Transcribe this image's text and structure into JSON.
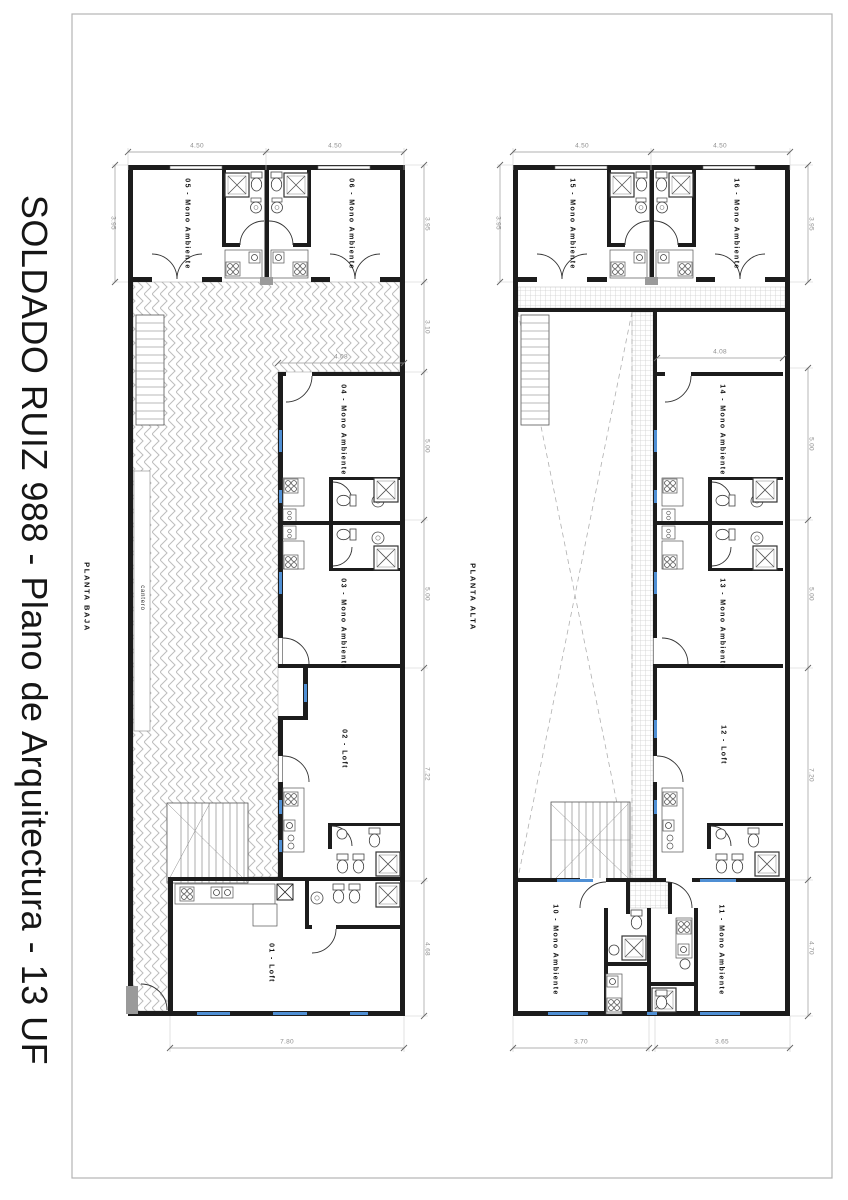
{
  "title": "SOLDADO RUIZ 988 - Plano de Arquitectura - 13 UF",
  "planta_baja": {
    "name": "PLANTA BAJA",
    "cantero": "cantero",
    "units": {
      "u01": "01 - Loft",
      "u02": "02 - Loft",
      "u03": "03 - Mono Ambiente",
      "u04": "04 - Mono Ambiente",
      "u05": "05 - Mono Ambiente",
      "u06": "06 - Mono Ambiente"
    },
    "dims": {
      "top": [
        "4.50",
        "4.50"
      ],
      "left": "3.95",
      "right": [
        "3.95",
        "3.10",
        "5.00",
        "5.00",
        "7.22",
        "4.68"
      ],
      "unit04_width": "4.08",
      "bottom": "7.80"
    }
  },
  "planta_alta": {
    "name": "PLANTA ALTA",
    "units": {
      "u10": "10 - Mono Ambiente",
      "u11": "11 - Mono Ambiente",
      "u12": "12 - Loft",
      "u13": "13 - Mono Ambiente",
      "u14": "14 - Mono Ambiente",
      "u15": "15 - Mono Ambiente",
      "u16": "16 - Mono Ambiente"
    },
    "dims": {
      "top": [
        "4.50",
        "4.50"
      ],
      "left": "3.95",
      "right": [
        "3.95",
        "5.00",
        "5.00",
        "7.20",
        "4.70"
      ],
      "unit14_width": "4.08",
      "bottom": [
        "3.70",
        "3.65"
      ]
    }
  },
  "colors": {
    "wall": "#1c1c1c",
    "window": "#4f8fd4",
    "dim": "#9a9a9a",
    "pattern": "#bdbdbd"
  }
}
